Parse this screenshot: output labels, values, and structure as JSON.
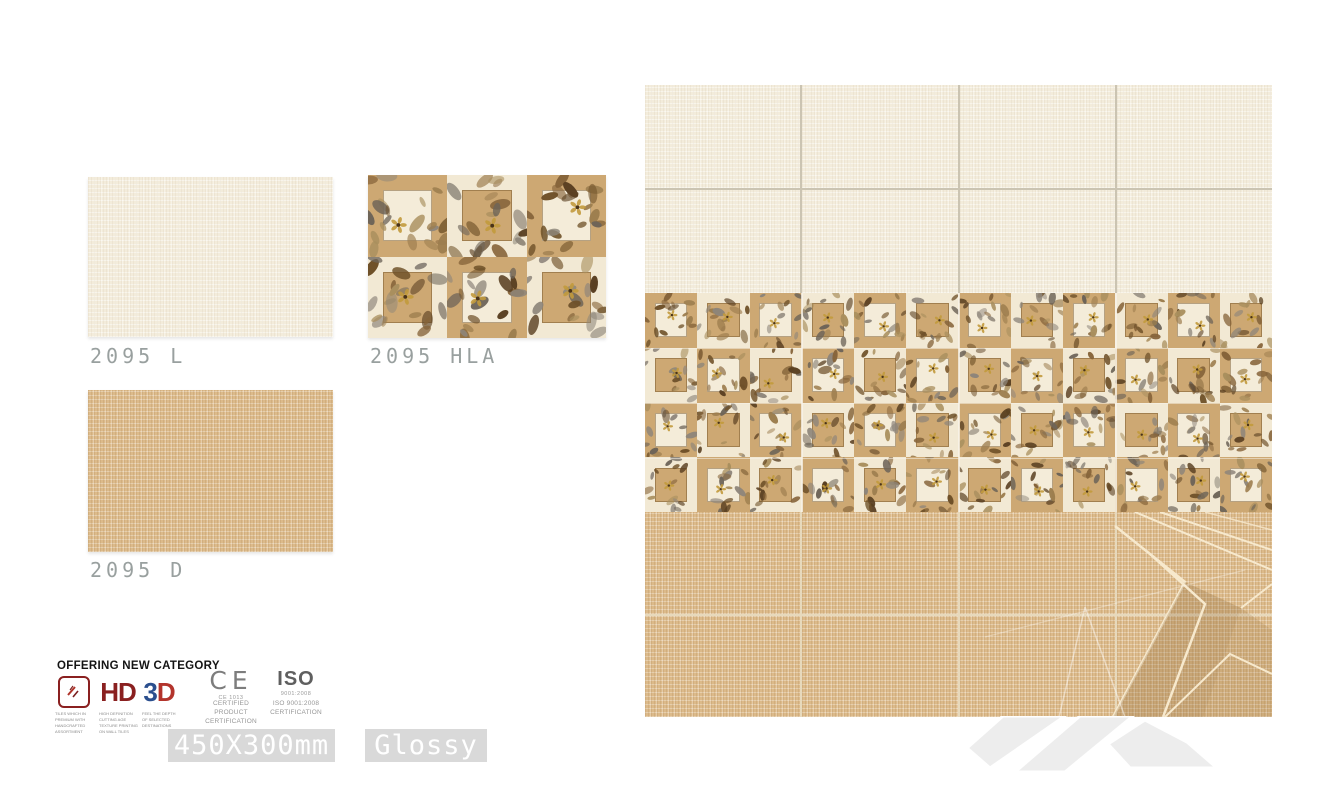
{
  "samples": [
    {
      "label": "2095 L",
      "type": "plain-light"
    },
    {
      "label": "2095 HLA",
      "type": "highlighter-decor"
    },
    {
      "label": "2095 D",
      "type": "plain-dark"
    }
  ],
  "category_section": {
    "title": "OFFERING NEW CATEGORY",
    "icons": [
      {
        "name": "tiles-icon",
        "caption": "TILES WHICH IN PREMIUM WITH HANDCRAFTED ASSORTMENT"
      },
      {
        "name": "hd-icon",
        "label": "HD",
        "caption": "HIGH DEFINITION CUTTING AGE TEXTURE PRINTING ON WALL TILES"
      },
      {
        "name": "3d-icon",
        "label3": "3",
        "labelD": "D",
        "caption": "FEEL THE DEPTH OF SELECTED DESTINATIONS"
      }
    ],
    "ce": {
      "mark": "CE",
      "code": "CE 1013",
      "desc_line1": "CERTIFIED PRODUCT",
      "desc_line2": "CERTIFICATION"
    },
    "iso": {
      "mark": "ISO",
      "code": "9001:2008",
      "desc_line1": "ISO 9001:2008",
      "desc_line2": "CERTIFICATION"
    }
  },
  "specs": {
    "size": "450X300mm",
    "finish": "Glossy"
  },
  "colors": {
    "cream_tile": "#f3ecdb",
    "tan_tile": "#dcba8a",
    "decor_frame_tan": "#cda873",
    "decor_center_cream": "#f4ecd9",
    "grout": "#cbc4b2",
    "label_gray": "#99a09f",
    "badge_bg": "#d9d9d9",
    "logo_red": "#8a2020",
    "logo_blue": "#2b4f8e"
  }
}
